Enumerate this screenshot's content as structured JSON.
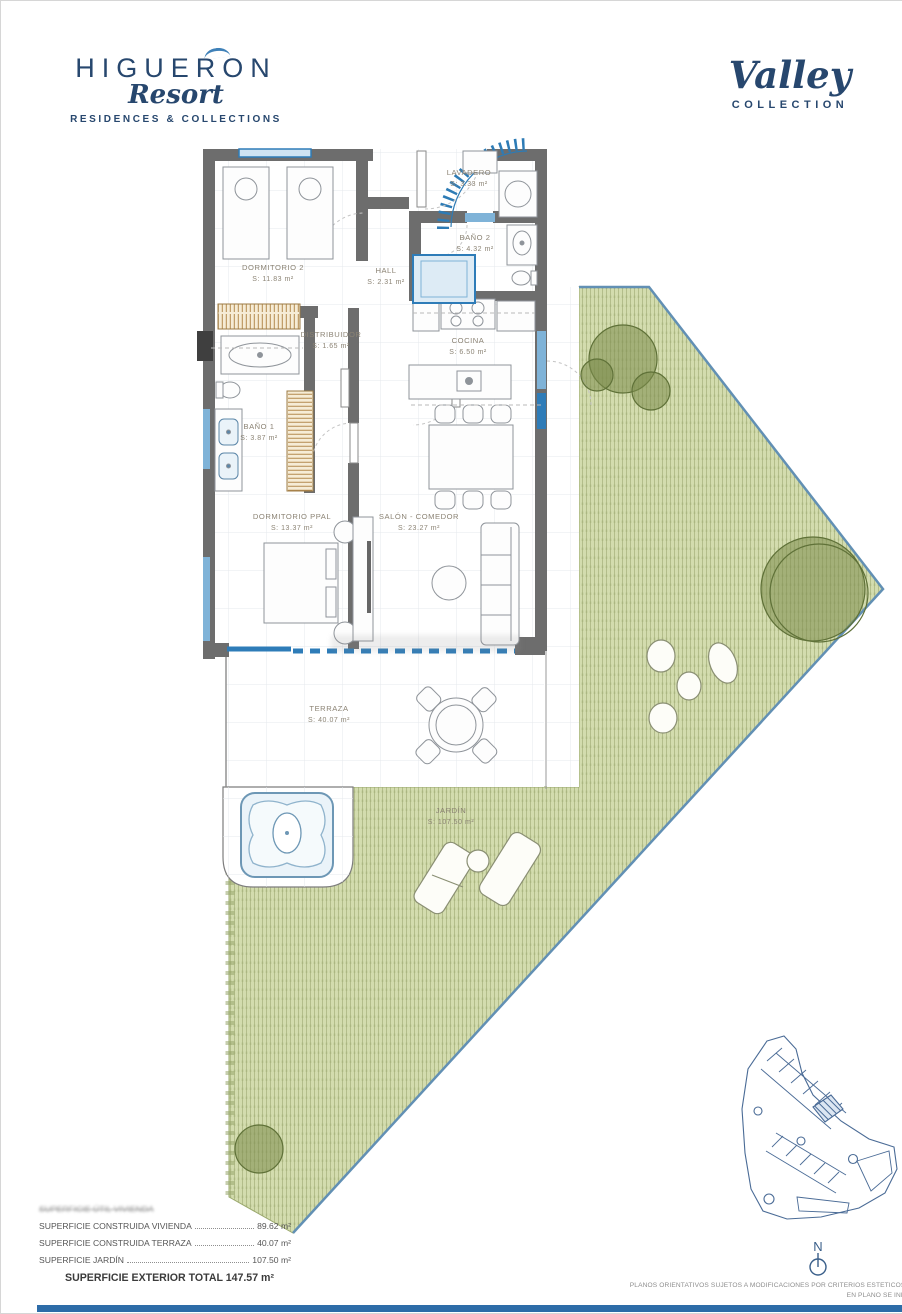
{
  "header": {
    "brand": {
      "name": "HIGUERON",
      "script": "Resort",
      "tagline": "RESIDENCES & COLLECTIONS"
    },
    "collection": {
      "script": "Valley",
      "label": "COLLECTION"
    }
  },
  "plan": {
    "rooms": [
      {
        "name": "LAVADERO",
        "area": "S: 3.33 m²"
      },
      {
        "name": "BAÑO 2",
        "area": "S: 4.32 m²"
      },
      {
        "name": "DORMITORIO 2",
        "area": "S: 11.83 m²"
      },
      {
        "name": "HALL",
        "area": "S: 2.31 m²"
      },
      {
        "name": "DISTRIBUIDOR",
        "area": "S: 1.65 m²"
      },
      {
        "name": "COCINA",
        "area": "S: 6.50 m²"
      },
      {
        "name": "BAÑO 1",
        "area": "S: 3.87 m²"
      },
      {
        "name": "DORMITORIO PPAL",
        "area": "S: 13.37 m²"
      },
      {
        "name": "SALÓN - COMEDOR",
        "area": "S: 23.27 m²"
      },
      {
        "name": "TERRAZA",
        "area": "S: 40.07 m²"
      },
      {
        "name": "JARDÍN",
        "area": "S: 107.50 m²"
      }
    ]
  },
  "summary": {
    "obscured_line": "SUPERFICIE ÚTIL VIVIENDA",
    "rows": [
      {
        "label": "SUPERFICIE CONSTRUIDA VIVIENDA",
        "value": "89.62 m²"
      },
      {
        "label": "SUPERFICIE CONSTRUIDA TERRAZA",
        "value": "40.07 m²"
      },
      {
        "label": "SUPERFICIE JARDÍN",
        "value": "107.50 m²"
      }
    ],
    "total": "SUPERFICIE EXTERIOR TOTAL 147.57 m²"
  },
  "footer": {
    "line1": "PLANOS ORIENTATIVOS SUJETOS A MODIFICACIONES POR CRITERIOS ESTETICOS, TECNICOS O ADMINISTRATIVOS. A.G.M. MAYO 20",
    "line2": "EN PLANO SE INDICAN LAS SUPERFICIES ÚTILES DE CADA ESTANC",
    "line3": "ESCALA 1:"
  },
  "compass": {
    "label": "N"
  },
  "colors": {
    "brand_navy": "#27476e",
    "wall_grey": "#6d6d6d",
    "window_blue": "#2e7cb8",
    "garden_green": "#d3dcae",
    "tree_green": "#7c8d4d",
    "keymap_blue": "#4a6b96",
    "bottom_bar_blue": "#2d6ca8"
  }
}
